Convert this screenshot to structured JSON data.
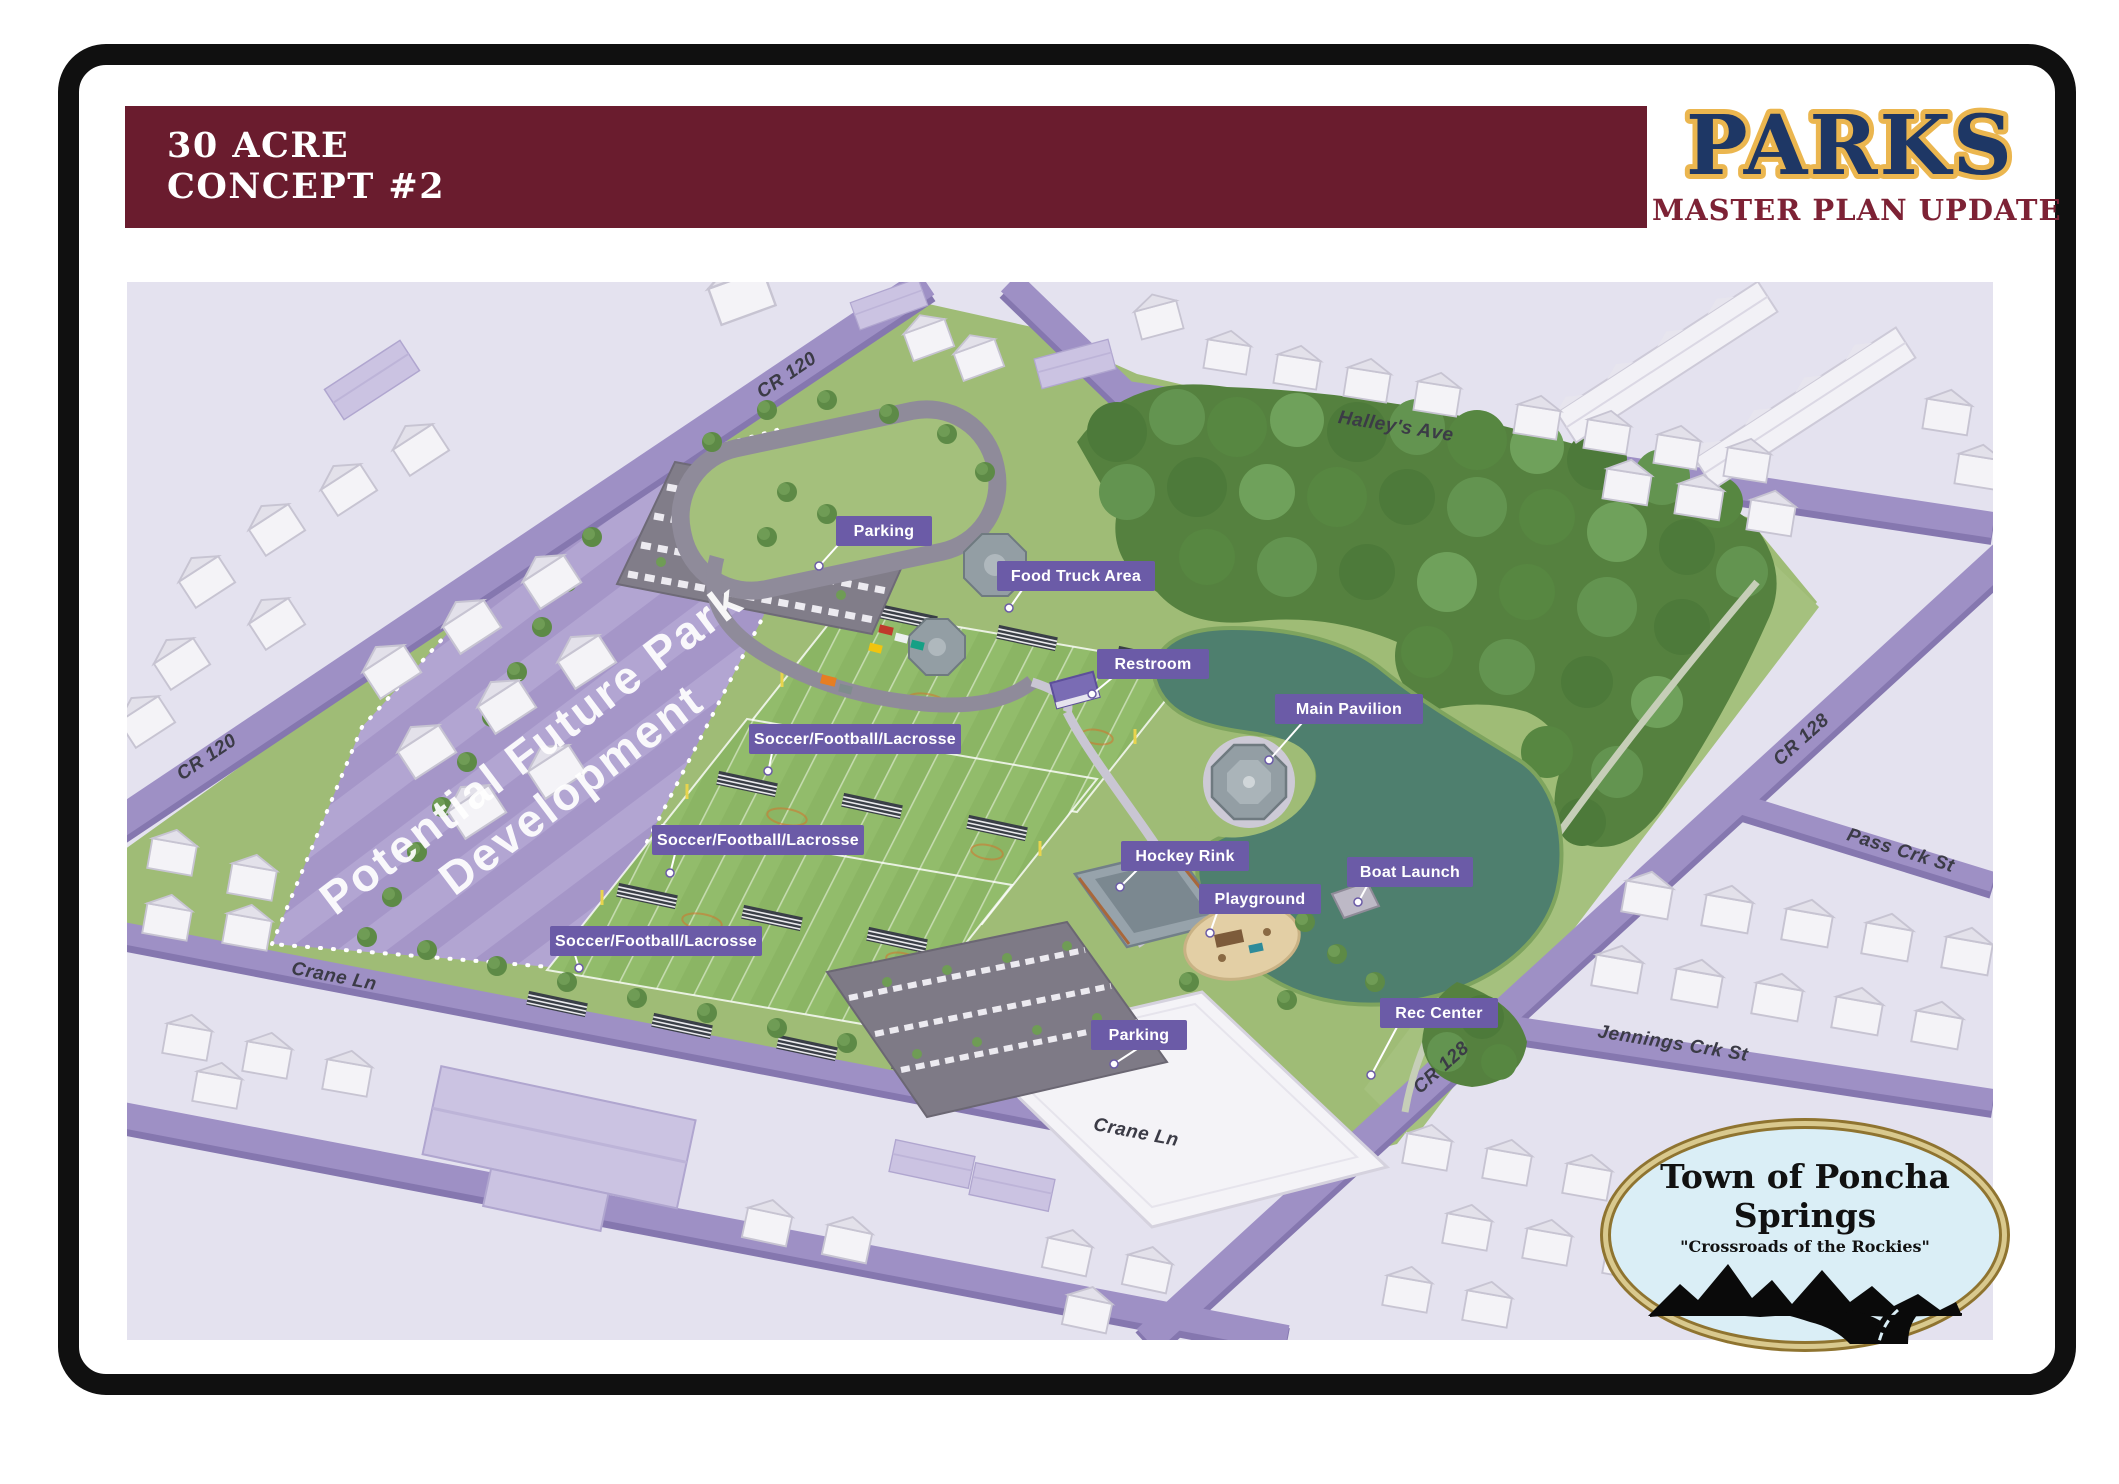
{
  "header": {
    "title_line1": "30 ACRE",
    "title_line2": "CONCEPT #2"
  },
  "brand": {
    "title": "PARKS",
    "subtitle": "MASTER PLAN UPDATE"
  },
  "map": {
    "area_label": {
      "line1": "Potential Future Park",
      "line2": "Development"
    },
    "labels": [
      {
        "id": "parking-north",
        "text": "Parking"
      },
      {
        "id": "food-truck-area",
        "text": "Food Truck Area"
      },
      {
        "id": "restroom",
        "text": "Restroom"
      },
      {
        "id": "main-pavilion",
        "text": "Main Pavilion"
      },
      {
        "id": "soccer-1",
        "text": "Soccer/Football/Lacrosse"
      },
      {
        "id": "soccer-2",
        "text": "Soccer/Football/Lacrosse"
      },
      {
        "id": "soccer-3",
        "text": "Soccer/Football/Lacrosse"
      },
      {
        "id": "hockey-rink",
        "text": "Hockey Rink"
      },
      {
        "id": "playground",
        "text": "Playground"
      },
      {
        "id": "boat-launch",
        "text": "Boat Launch"
      },
      {
        "id": "rec-center",
        "text": "Rec Center"
      },
      {
        "id": "parking-south",
        "text": "Parking"
      }
    ],
    "streets": [
      {
        "id": "cr120-top",
        "name": "CR 120"
      },
      {
        "id": "cr120-left",
        "name": "CR 120"
      },
      {
        "id": "halleys-ave",
        "name": "Halley's Ave"
      },
      {
        "id": "cr128-upper",
        "name": "CR 128"
      },
      {
        "id": "pass-crk",
        "name": "Pass Crk St"
      },
      {
        "id": "jennings-crk",
        "name": "Jennings Crk St"
      },
      {
        "id": "cr128-lower",
        "name": "CR 128"
      },
      {
        "id": "crane-left",
        "name": "Crane Ln"
      },
      {
        "id": "crane-center",
        "name": "Crane Ln"
      }
    ]
  },
  "logo": {
    "town": "Town of Poncha Springs",
    "tagline": "\"Crossroads of the Rockies\""
  },
  "colors": {
    "header_bar": "#6A1C2E",
    "brand_navy": "#1E3765",
    "brand_gold": "#EBB64F",
    "brand_maroon": "#7D2235",
    "label_purple": "#6B5BA7",
    "road_purple": "#9E90C5",
    "zone_purple": "#AC9ECE",
    "park_green": "#9FBC76",
    "pond_teal": "#4E7F6E",
    "map_bg": "#E4E2EF"
  }
}
